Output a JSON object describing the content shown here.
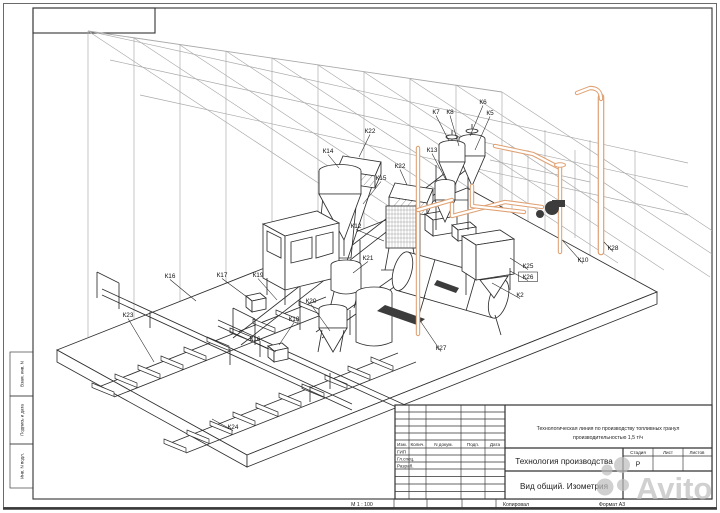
{
  "frame": {
    "side_cells": [
      "Взам. инв. N",
      "Подпись и дата",
      "Инв. N подл."
    ],
    "bottom": {
      "scale": "М 1 : 100",
      "copied": "Копировал",
      "format": "Формат А3"
    }
  },
  "title_block": {
    "project": [
      "Технологическая линия по производству топливных гранул",
      "производительностью 1,5 т/ч"
    ],
    "doc_title": "Технология производства",
    "view_title": "Вид общий. Изометрия",
    "header_cols": [
      "Изм.",
      "Колич.",
      "N докум.",
      "Подп.",
      "Дата"
    ],
    "roles": [
      "ГИП",
      "Гл.спец.",
      "Разраб."
    ],
    "stage_cols": [
      "Стадия",
      "Лист",
      "Листов"
    ],
    "stage_value": "Р"
  },
  "watermark": {
    "text": "Avito"
  },
  "drawing": {
    "colors": {
      "pipe": "#dfa173",
      "ink": "#2f2f2f",
      "roof": "#a9a9a9",
      "watermark": "#bdbdbd"
    },
    "labels": [
      {
        "text": "К7",
        "x": 436,
        "y": 114,
        "lx": 449,
        "ly": 141
      },
      {
        "text": "К8",
        "x": 450,
        "y": 114,
        "lx": 459,
        "ly": 146
      },
      {
        "text": "К6",
        "x": 483,
        "y": 104,
        "lx": 470,
        "ly": 136
      },
      {
        "text": "К5",
        "x": 490,
        "y": 115,
        "lx": 475,
        "ly": 150
      },
      {
        "text": "К13",
        "x": 432,
        "y": 152,
        "lx": 446,
        "ly": 180
      },
      {
        "text": "К14",
        "x": 328,
        "y": 153,
        "lx": 339,
        "ly": 168
      },
      {
        "text": "К22",
        "x": 370,
        "y": 133,
        "lx": 359,
        "ly": 157
      },
      {
        "text": "К22",
        "x": 400,
        "y": 168,
        "lx": 407,
        "ly": 185
      },
      {
        "text": "К15",
        "x": 381,
        "y": 180,
        "lx": 363,
        "ly": 204
      },
      {
        "text": "К12",
        "x": 356,
        "y": 228,
        "lx": 384,
        "ly": 241
      },
      {
        "text": "К21",
        "x": 368,
        "y": 260,
        "lx": 353,
        "ly": 273
      },
      {
        "text": "К20",
        "x": 311,
        "y": 303,
        "lx": 330,
        "ly": 331
      },
      {
        "text": "К19",
        "x": 258,
        "y": 277,
        "lx": 277,
        "ly": 300
      },
      {
        "text": "К17",
        "x": 222,
        "y": 277,
        "lx": 247,
        "ly": 297
      },
      {
        "text": "К16",
        "x": 170,
        "y": 278,
        "lx": 196,
        "ly": 301
      },
      {
        "text": "К16",
        "x": 255,
        "y": 341,
        "lx": 276,
        "ly": 352
      },
      {
        "text": "К18",
        "x": 294,
        "y": 321,
        "lx": 279,
        "ly": 345
      },
      {
        "text": "К23",
        "x": 128,
        "y": 317,
        "lx": 154,
        "ly": 362
      },
      {
        "text": "К24",
        "x": 233,
        "y": 429,
        "lx": 212,
        "ly": 419
      },
      {
        "text": "К27",
        "x": 441,
        "y": 350,
        "lx": 421,
        "ly": 322
      },
      {
        "text": "К25",
        "x": 528,
        "y": 268,
        "lx": 510,
        "ly": 258
      },
      {
        "text": "К26",
        "x": 528,
        "y": 279,
        "boxed": true,
        "lx": 510,
        "ly": 271
      },
      {
        "text": "К2",
        "x": 520,
        "y": 297,
        "lx": 492,
        "ly": 283
      },
      {
        "text": "К10",
        "x": 583,
        "y": 262,
        "lx": 563,
        "ly": 241
      },
      {
        "text": "К28",
        "x": 613,
        "y": 250,
        "lx": 604,
        "ly": 242
      }
    ]
  }
}
